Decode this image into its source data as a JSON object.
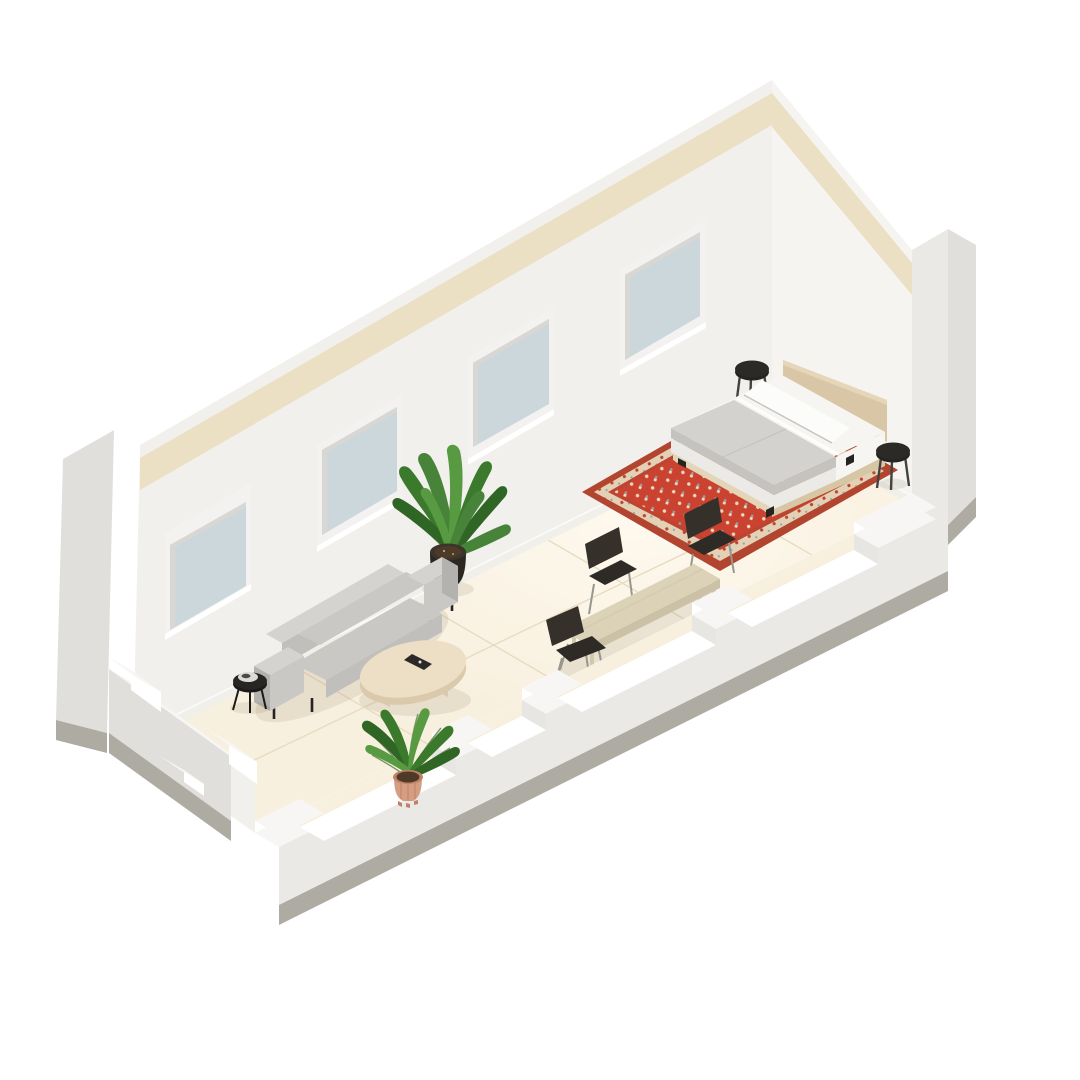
{
  "scene": {
    "type": "isometric-room-cutaway-render",
    "description": "3D isometric cutaway render of a long studio room with bed, oriental rug, dining set, sofa, coffee table and plants",
    "background": "#ffffff"
  },
  "inventory": {
    "windows": 4,
    "beds": 1,
    "pillows": 2,
    "stools": 2,
    "rugs": 1,
    "dining_tables": 1,
    "dining_chairs": 3,
    "sofas": 1,
    "coffee_tables": 1,
    "side_tables": 1,
    "plants": 2
  },
  "colors": {
    "bg": "#ffffff",
    "wall": "#f1f0ed",
    "wallRight": "#f5f4f1",
    "wallShade": "#e7e6e3",
    "cap": "#f7f6f4",
    "capBright": "#ffffff",
    "band": "#ebdfc4",
    "extFace": "#eae9e6",
    "extGray": "#e0dfdc",
    "concrete": "#aeaba2",
    "concreteDark": "#a19e95",
    "baseboard": "#fafaf8",
    "frame": "#f3f2f0",
    "frameShade": "#d8d7d4",
    "glass": "#ccd7db",
    "glassLight": "#dee7ea",
    "floor": "#f8f0df",
    "floorWarm": "#fdf7e9",
    "seam": "#e8dbc1",
    "shadow": "rgba(116,98,62,0.12)",
    "ao": "rgba(116,98,62,0.07)",
    "rugBorder": "#b2452f",
    "rugBand": "#e4d1b5",
    "rugGuard": "#bc4430",
    "rugField": "#cb4330",
    "rugCream": "#eadbbf",
    "rugSlate": "#8da4ae",
    "headboard": "#d9c6a6",
    "headboardLight": "#e6d6b9",
    "platform": "#e3d5b7",
    "platformSide": "#d6c6a4",
    "sheet": "#f6f5f2",
    "mattress": "#eceae6",
    "duvet": "#d3d2cf",
    "duvetShade": "#c4c3c0",
    "pillow": "#fcfcfb",
    "black": "#262421",
    "stoolSeat": "#2b2a27",
    "stoolLeg": "#44423e",
    "metal": "#97968f",
    "chair": "#36302a",
    "chairSeat": "#2e2a25",
    "tableTop": "#dcd2b8",
    "tableSide": "#cbc1a6",
    "tableLeg": "#d2c8ad",
    "coffeeTop": "#eddec6",
    "coffeeSide": "#dbc9ab",
    "sofa": "#c9c8c4",
    "sofaLight": "#d4d3d0",
    "sofaMid": "#c0bfbb",
    "sofaDark": "#b3b2ae",
    "sideTable": "#272625",
    "sideTableDark": "#1c1b1a",
    "tray": "#dcdbd7",
    "trayItem": "#4a4947",
    "potBlack": "#2c2721",
    "potRim": "#3a342c",
    "soil": "#4e3a26",
    "green1": "#478339",
    "green2": "#3b7a2c",
    "green3": "#2f6625",
    "green4": "#579a41",
    "stem": "#7e9466",
    "terra": "#d59d82",
    "terraDark": "#bf8269",
    "remote": "#2b2a28",
    "remoteDot": "#e8e7e5"
  }
}
